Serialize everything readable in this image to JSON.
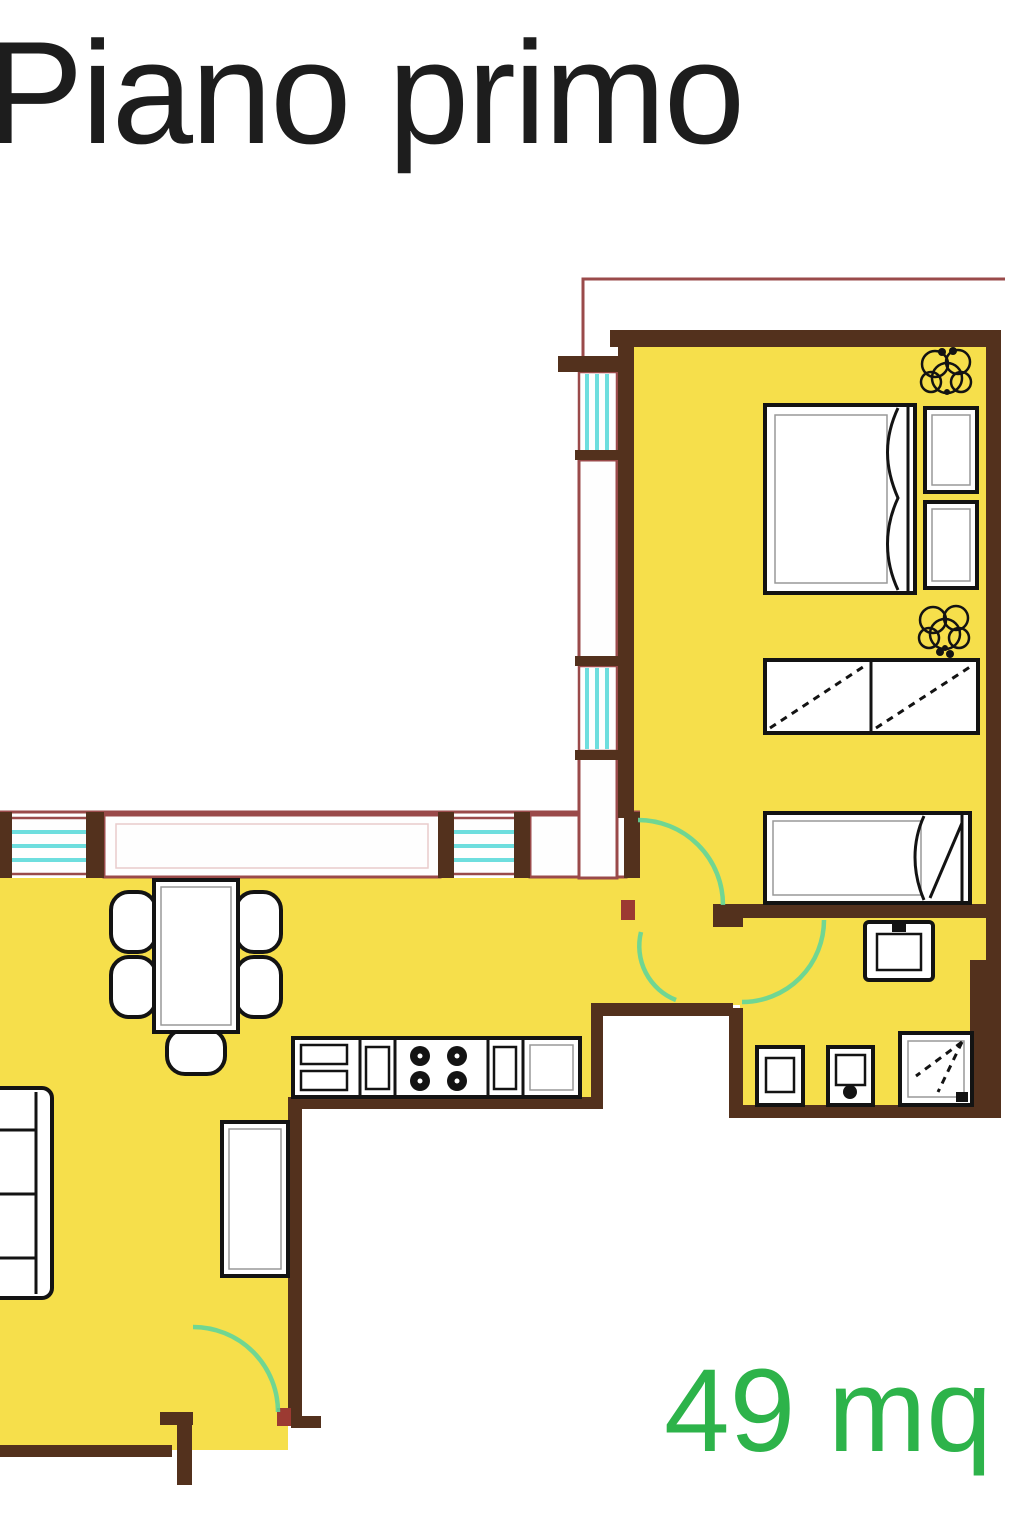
{
  "title": "Piano primo",
  "area_label": "49 mq",
  "colors": {
    "background": "#ffffff",
    "floor": "#f6df4b",
    "wall": "#53311d",
    "wall_accent": "#9c3a32",
    "window_frame": "#9a4a4a",
    "window_glass": "#6edede",
    "door_arc": "#62d59a",
    "furniture_outline": "#131313",
    "title_text": "#1d1d1d",
    "area_text": "#2db34a"
  }
}
